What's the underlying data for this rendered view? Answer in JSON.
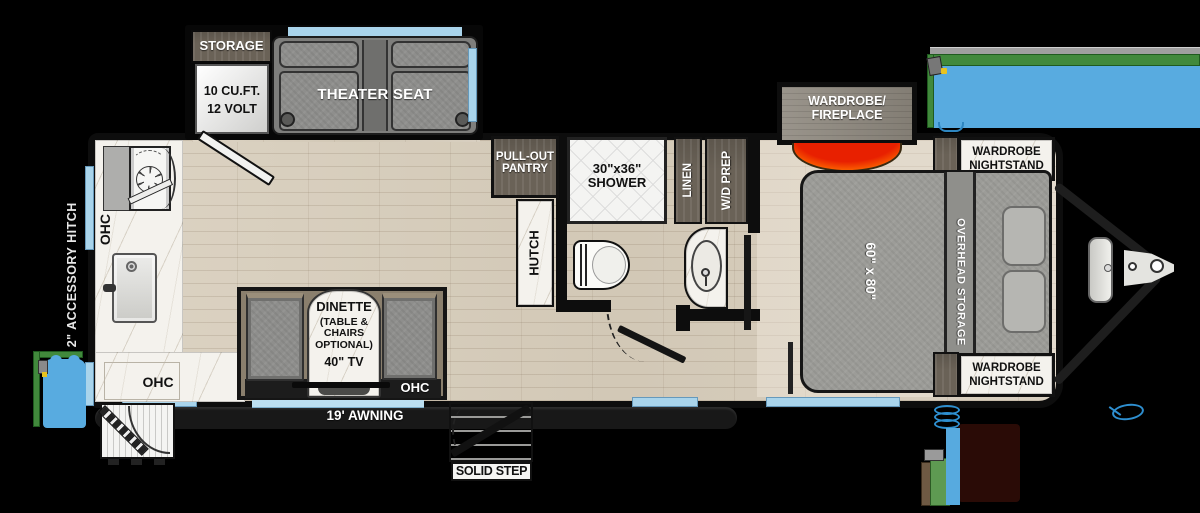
{
  "title": "Travel trailer floor plan",
  "colors": {
    "background": "#000000",
    "floor_wood": "#d7cdbd",
    "counter_marble": "#f4f2ed",
    "cabinet_dark_wood": "#6a6257",
    "slide_wood": "#8e887e",
    "furniture_gray": "#8e8e8c",
    "window_blue": "#a9d4eb",
    "awning_blue": "#58abe0",
    "awning_green": "#41893c",
    "flame_red": "#e82000",
    "flame_yellow": "#ffd900",
    "wall_black": "#0d0d0d"
  },
  "labels": {
    "storage": "STORAGE",
    "fridge_line1": "10 CU.FT.",
    "fridge_line2": "12 VOLT",
    "theater_seat": "THEATER SEAT",
    "pantry_line1": "PULL-OUT",
    "pantry_line2": "PANTRY",
    "hutch": "HUTCH",
    "shower_line1": "30\"x36\"",
    "shower_line2": "SHOWER",
    "linen": "LINEN",
    "wd_prep": "W/D PREP",
    "wardrobe_fireplace_line1": "WARDROBE/",
    "wardrobe_fireplace_line2": "FIREPLACE",
    "nightstand_line1": "WARDROBE",
    "nightstand_line2": "NIGHTSTAND",
    "overhead_storage": "OVERHEAD STORAGE",
    "bed_size": "60\" x 80\"",
    "dinette_line1": "DINETTE",
    "dinette_line2": "(TABLE &",
    "dinette_line3": "CHAIRS",
    "dinette_line4": "OPTIONAL)",
    "tv": "40\" TV",
    "ohc": "OHC",
    "awning": "19' AWNING",
    "solid_step": "SOLID STEP",
    "accessory_hitch": "2\" ACCESSORY HITCH"
  }
}
